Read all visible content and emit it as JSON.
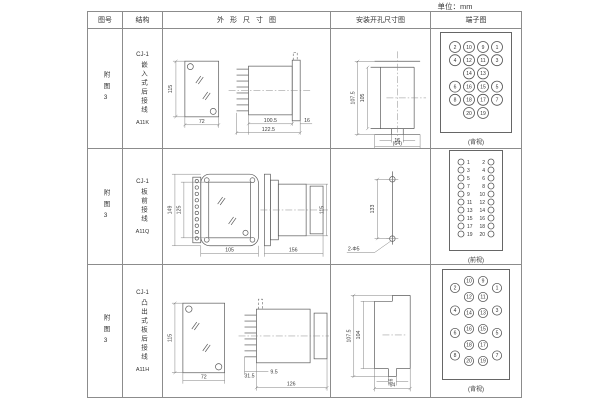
{
  "unit_label": "单位：mm",
  "header": {
    "fig_no": "图号",
    "structure": "结构",
    "outline": "外形尺寸图",
    "mounting": "安装开孔尺寸图",
    "terminal": "端子图"
  },
  "rows": [
    {
      "fig_no": "附图3",
      "series": "CJ-1",
      "structure": "嵌入式后接线",
      "model": "A11K",
      "outline": {
        "front_height": "115",
        "front_width": "72",
        "body_length": "100.5",
        "flange_depth": "16",
        "total_length": "122.5"
      },
      "mounting": {
        "outer_height": "107.5",
        "inner_height": "105",
        "slot_width": "16",
        "opening_width": "(64)"
      },
      "terminal": {
        "style": "numbered",
        "view_label": "(背视)",
        "columns": [
          [
            "2",
            "4",
            null,
            "6",
            "8",
            null
          ],
          [
            "10",
            "12",
            "14",
            "16",
            "18",
            "20"
          ],
          [
            "9",
            "11",
            "13",
            "15",
            "17",
            "19"
          ],
          [
            "1",
            "3",
            null,
            "5",
            "7",
            null
          ]
        ]
      }
    },
    {
      "fig_no": "附图3",
      "series": "CJ-1",
      "structure": "板前接线",
      "model": "A11Q",
      "outline": {
        "front_outer_height": "149",
        "front_inner_height": "125",
        "front_width": "105",
        "side_length": "156",
        "side_height": "115"
      },
      "mounting": {
        "hole_spacing": "133",
        "holes": "2-Φ5"
      },
      "terminal": {
        "style": "pairs",
        "view_label": "(前视)",
        "pairs": [
          [
            "1",
            "2"
          ],
          [
            "3",
            "4"
          ],
          [
            "5",
            "6"
          ],
          [
            "7",
            "8"
          ],
          [
            "9",
            "10"
          ],
          [
            "11",
            "12"
          ],
          [
            "13",
            "14"
          ],
          [
            "15",
            "16"
          ],
          [
            "17",
            "18"
          ],
          [
            "19",
            "20"
          ]
        ]
      }
    },
    {
      "fig_no": "附图3",
      "series": "CJ-1",
      "structure": "凸出式板后接线",
      "model": "A11H",
      "outline": {
        "front_height": "115",
        "front_width": "72",
        "stud_length": "31.5",
        "offset": "9.5",
        "body_length": "126"
      },
      "mounting": {
        "outer_height": "107.5",
        "inner_height": "104",
        "slot_width": "16",
        "opening_width": "64"
      },
      "terminal": {
        "style": "staggered",
        "view_label": "(背视)",
        "columns": [
          [
            "2",
            "4",
            "6",
            "8"
          ],
          [
            "10",
            "12",
            "14",
            "16",
            "18",
            "20"
          ],
          [
            "9",
            "11",
            "13",
            "15",
            "17",
            "19"
          ],
          [
            "1",
            "3",
            "5",
            "7"
          ]
        ]
      }
    }
  ]
}
